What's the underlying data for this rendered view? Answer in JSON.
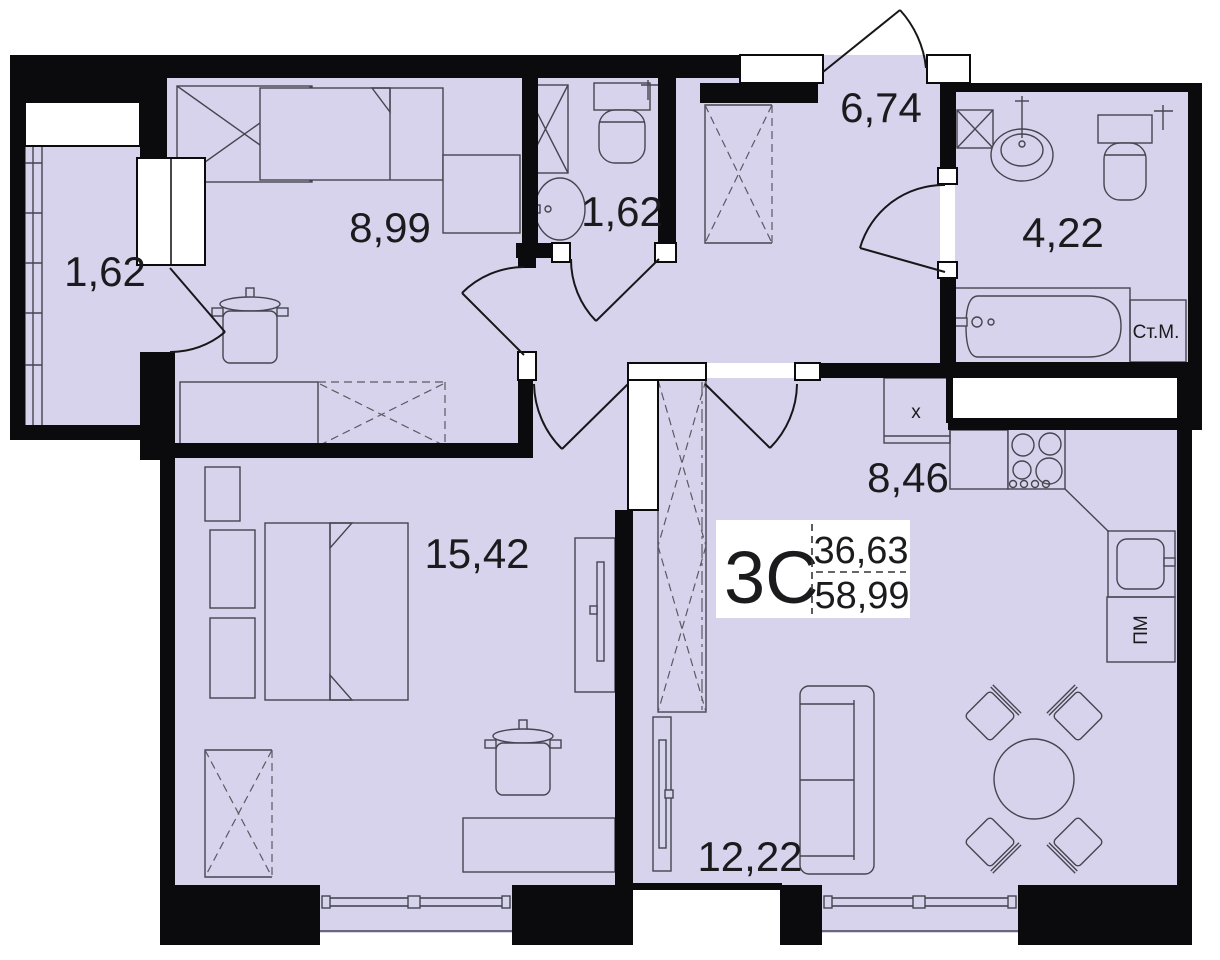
{
  "plan_stamp": {
    "unit_label": "3С",
    "value_top": "36,63",
    "value_bottom": "58,99"
  },
  "rooms": [
    {
      "name": "loggia",
      "label": "1,62"
    },
    {
      "name": "bedroom-secondary",
      "label": "8,99"
    },
    {
      "name": "wc",
      "label": "1,62"
    },
    {
      "name": "hallway",
      "label": "6,74"
    },
    {
      "name": "bathroom",
      "label": "4,22"
    },
    {
      "name": "kitchen",
      "label": "8,46"
    },
    {
      "name": "bedroom-main",
      "label": "15,42"
    },
    {
      "name": "living-room",
      "label": "12,22"
    }
  ],
  "appliances": {
    "washing_machine": "Ст.М.",
    "dishwasher": "ПМ",
    "fridge": "х"
  },
  "colors": {
    "floor": "#d8d3ec",
    "wall": "#0b0b0d",
    "accent": "#45454f"
  }
}
